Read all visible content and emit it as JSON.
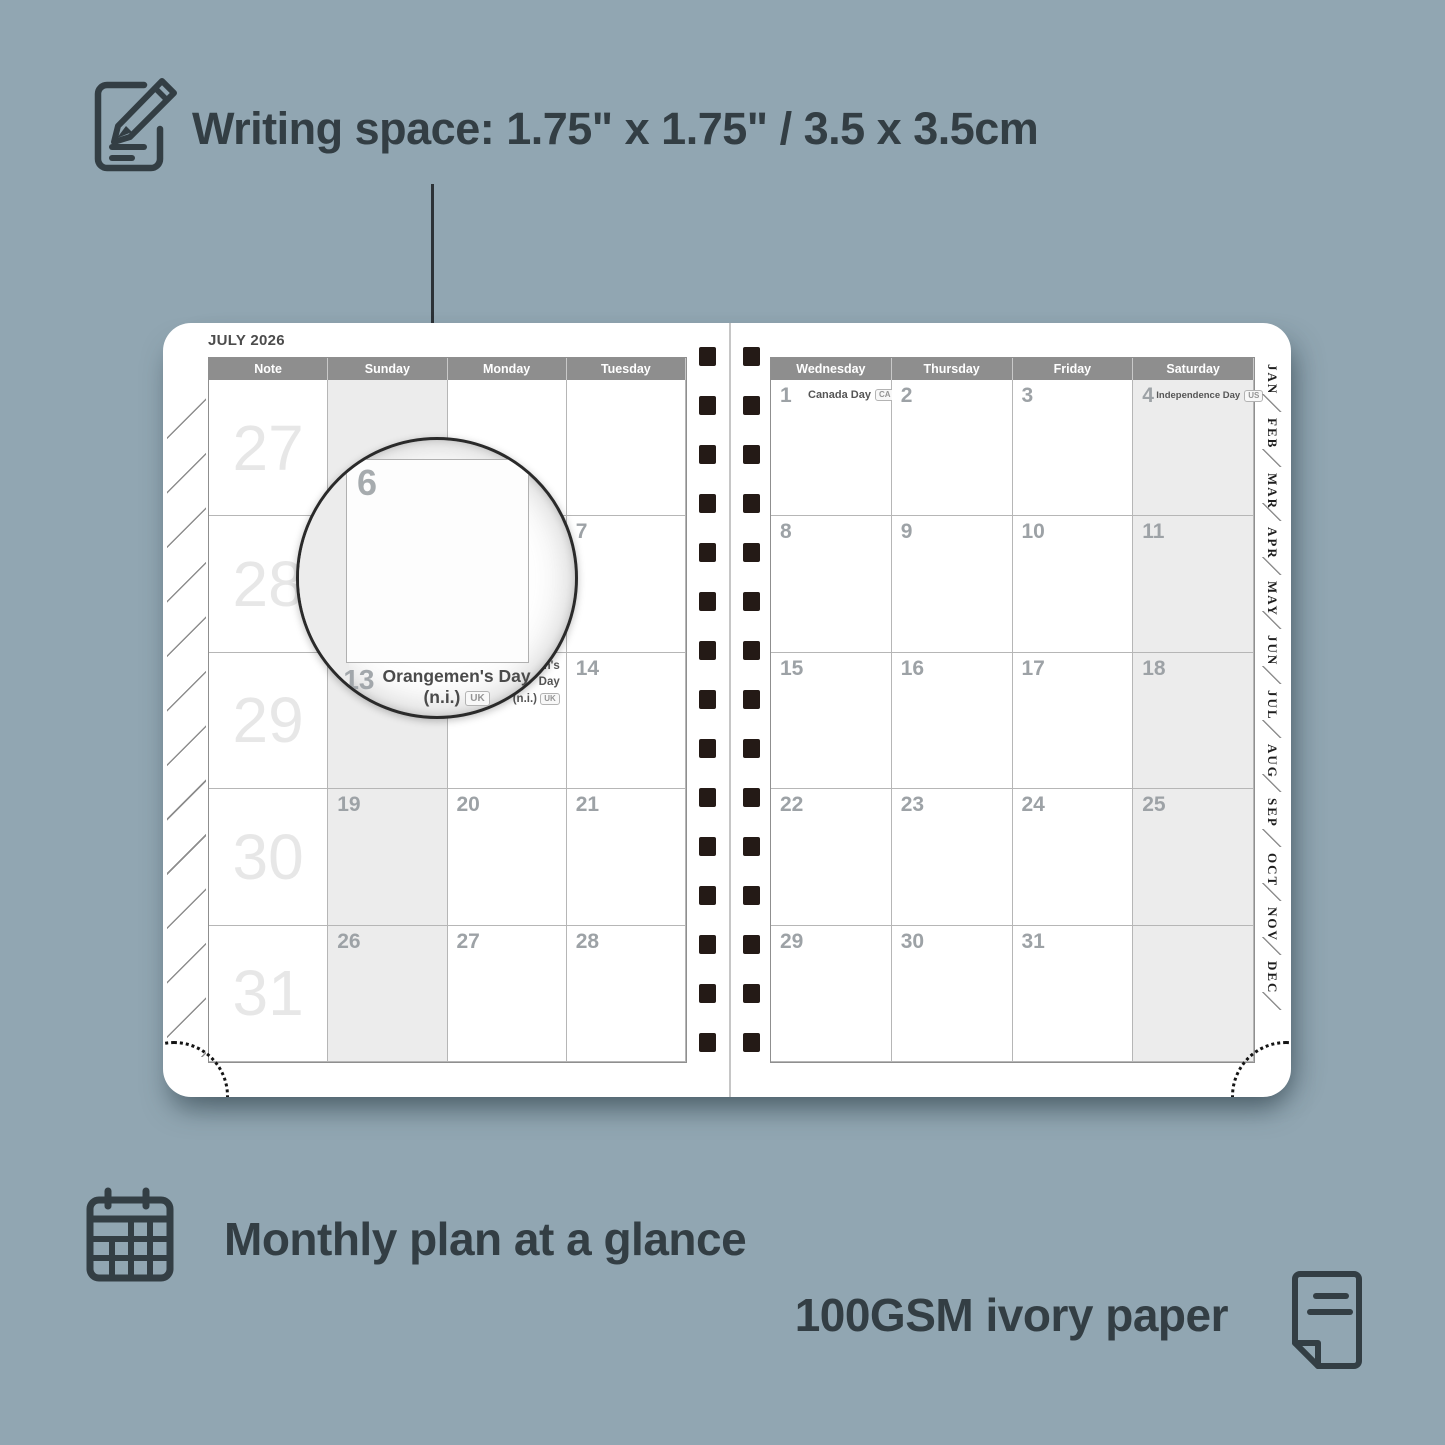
{
  "colors": {
    "background": "#91a6b2",
    "ink": "#333e44",
    "calendar_header_fill": "#8e8e8e",
    "weekend_fill": "#ececec",
    "binding_hole": "#241a16"
  },
  "top_caption": {
    "icon": "pencil-note-icon",
    "text": "Writing space: 1.75\" x 1.75\" / 3.5 x 3.5cm"
  },
  "planner": {
    "month_title": "JULY 2026",
    "left_page": {
      "headers": [
        "Note",
        "Sunday",
        "Monday",
        "Tuesday"
      ],
      "week_numbers": [
        "27",
        "28",
        "29",
        "30",
        "31"
      ],
      "weekend_cols": [
        1
      ],
      "weeks": [
        [
          {
            "d": ""
          },
          {
            "d": ""
          },
          {
            "d": ""
          }
        ],
        [
          {
            "d": ""
          },
          {
            "d": ""
          },
          {
            "d": "7"
          }
        ],
        [
          {
            "d": ""
          },
          {
            "d": "13",
            "holiday": {
              "name": "Orangemen's Day",
              "sub": "(n.i.)",
              "badge": "UK",
              "align": "right"
            }
          },
          {
            "d": "14"
          }
        ],
        [
          {
            "d": "19"
          },
          {
            "d": "20"
          },
          {
            "d": "21"
          }
        ],
        [
          {
            "d": "26"
          },
          {
            "d": "27"
          },
          {
            "d": "28"
          }
        ]
      ]
    },
    "right_page": {
      "headers": [
        "Wednesday",
        "Thursday",
        "Friday",
        "Saturday"
      ],
      "weekend_cols": [
        3
      ],
      "weeks": [
        [
          {
            "d": "1",
            "holiday": {
              "name": "Canada Day",
              "badge": "CA",
              "align": "row"
            }
          },
          {
            "d": "2"
          },
          {
            "d": "3"
          },
          {
            "d": "4",
            "holiday": {
              "name": "Independence Day",
              "badge": "US",
              "align": "row",
              "small": true
            }
          }
        ],
        [
          {
            "d": "8"
          },
          {
            "d": "9"
          },
          {
            "d": "10"
          },
          {
            "d": "11"
          }
        ],
        [
          {
            "d": "15"
          },
          {
            "d": "16"
          },
          {
            "d": "17"
          },
          {
            "d": "18"
          }
        ],
        [
          {
            "d": "22"
          },
          {
            "d": "23"
          },
          {
            "d": "24"
          },
          {
            "d": "25"
          }
        ],
        [
          {
            "d": "29"
          },
          {
            "d": "30"
          },
          {
            "d": "31"
          },
          {
            "d": ""
          }
        ]
      ]
    },
    "month_tabs": [
      "JAN",
      "FEB",
      "MAR",
      "APR",
      "MAY",
      "JUN",
      "JUL",
      "AUG",
      "SEP",
      "OCT",
      "NOV",
      "DEC"
    ],
    "binding_squares_per_column": 15
  },
  "magnifier": {
    "zoom_day": "6",
    "caption_day": "13",
    "caption_name": "Orangemen's Day",
    "caption_sub": "(n.i.)",
    "caption_badge": "UK"
  },
  "features": [
    {
      "icon": "calendar-grid-icon",
      "text": "Monthly plan at a glance"
    },
    {
      "icon": "paper-sheet-icon",
      "text": "100GSM ivory paper"
    }
  ]
}
